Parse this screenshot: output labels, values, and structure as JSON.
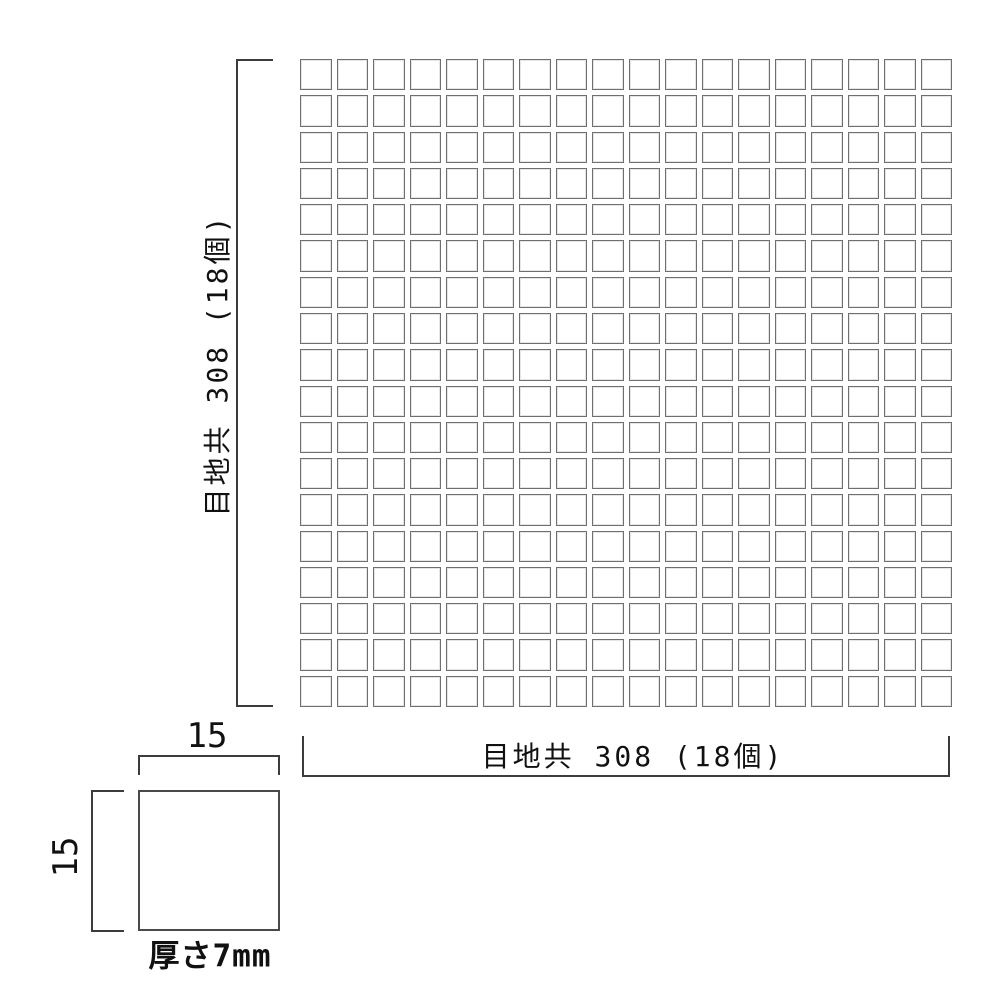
{
  "drawing": {
    "title": "mosaic tile sheet dimension drawing",
    "sheet": {
      "rows": 18,
      "cols": 18,
      "vertical_dimension_label": "目地共 308 (18個)",
      "horizontal_dimension_label": "目地共 308 (18個)"
    },
    "tile_detail": {
      "width_label": "15",
      "height_label": "15",
      "thickness_label": "厚さ7mm"
    },
    "colors": {
      "background": "#ffffff",
      "tile_border": "#6f6f6f",
      "dimension_line": "#3c3c3c",
      "text": "#111111"
    }
  }
}
